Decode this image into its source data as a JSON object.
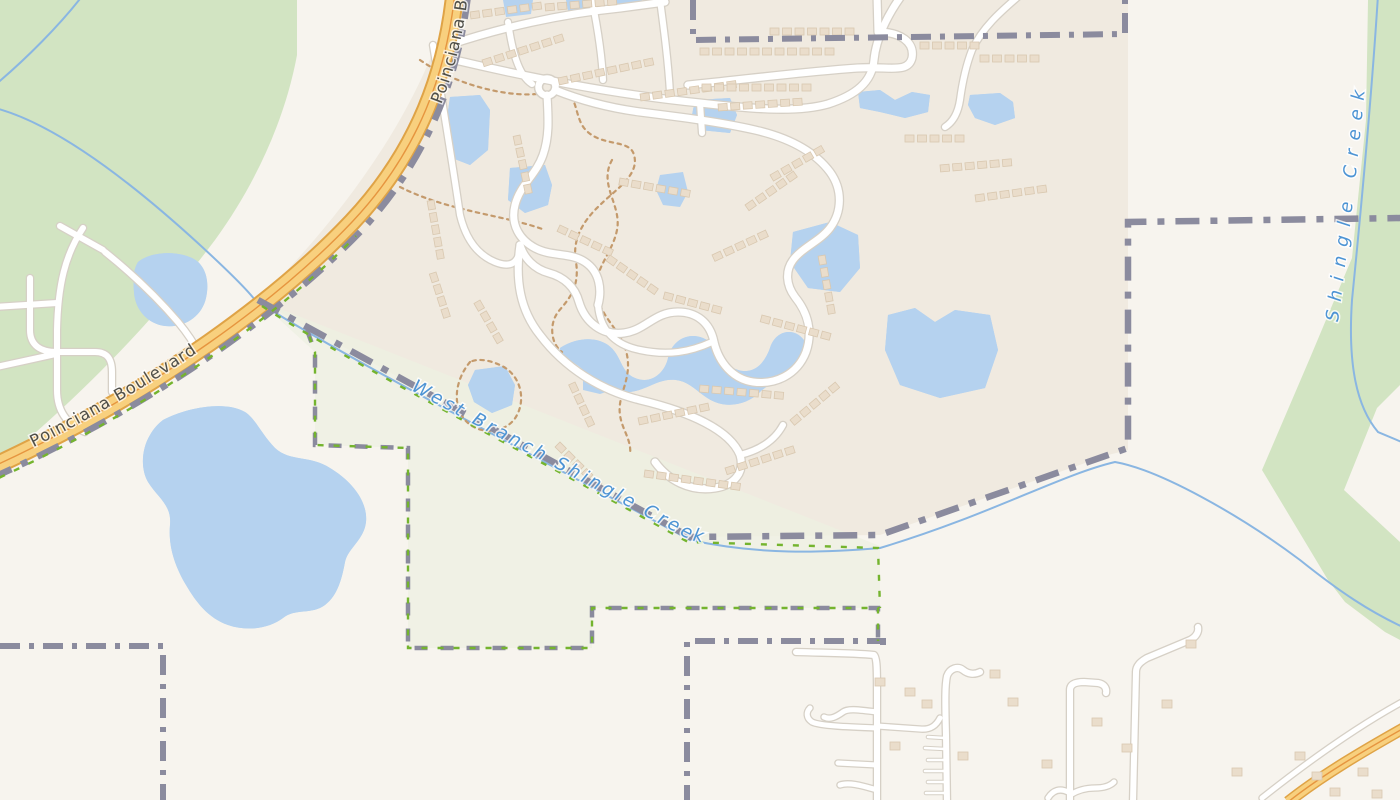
{
  "labels": {
    "poinciana_boulevard": "Poinciana Boulevard",
    "poinciana_boulevard_top": "Poinciana Boulevard",
    "west_branch_shingle_creek": "West Branch Shingle Creek",
    "shingle_creek": "Shingle Creek"
  },
  "colors": {
    "base": "#f7f4ee",
    "residential": "#f0eae0",
    "forest": "#d2e4c2",
    "park_tint": "#eef0e1",
    "water": "#b5d2ef",
    "water_wave": "#a2c1e2",
    "stream": "#8ab6e2",
    "road_primary": "#f8d07e",
    "road_casing": "#dfa346",
    "road_centerline": "#e6953f",
    "road_casing_white": "#d6d0c6",
    "boundary": "#8b8b9e",
    "park_boundary_green": "#74b42e",
    "footpath": "#c49a6c",
    "building": "#eaddcb",
    "building_line": "#d9c8b0",
    "road_label": "#4e4e48",
    "water_label": "#4d94d4"
  }
}
